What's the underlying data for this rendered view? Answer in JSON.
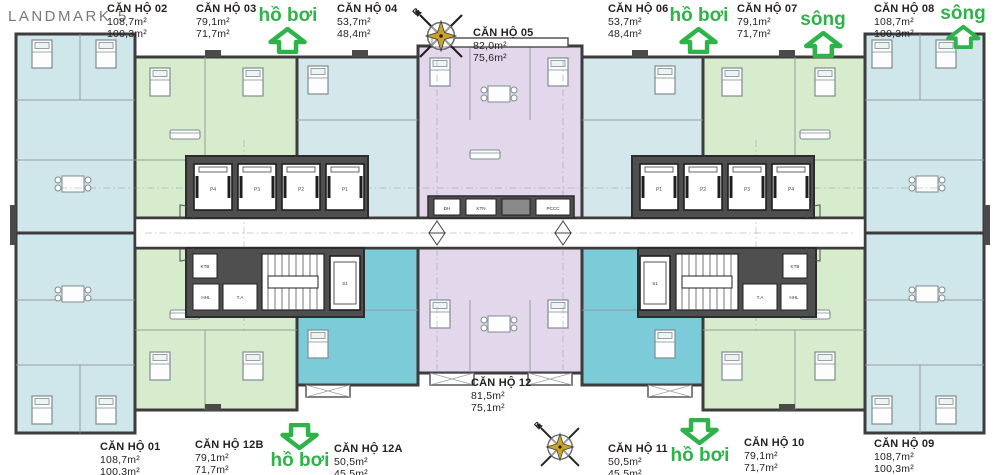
{
  "title": "LANDMARK 5",
  "units": {
    "u01": {
      "name": "CĂN HỘ 01",
      "area1": "108,7m²",
      "area2": "100,3m²"
    },
    "u02": {
      "name": "CĂN HỘ 02",
      "area1": "108,7m²",
      "area2": "100,3m²"
    },
    "u03": {
      "name": "CĂN HỘ 03",
      "area1": "79,1m²",
      "area2": "71,7m²"
    },
    "u04": {
      "name": "CĂN HỘ 04",
      "area1": "53,7m²",
      "area2": "48,4m²"
    },
    "u05": {
      "name": "CĂN HỘ 05",
      "area1": "82,0m²",
      "area2": "75,6m²"
    },
    "u06": {
      "name": "CĂN HỘ 06",
      "area1": "53,7m²",
      "area2": "48,4m²"
    },
    "u07": {
      "name": "CĂN HỘ 07",
      "area1": "79,1m²",
      "area2": "71,7m²"
    },
    "u08": {
      "name": "CĂN HỘ 08",
      "area1": "108,7m²",
      "area2": "100,3m²"
    },
    "u09": {
      "name": "CĂN HỘ 09",
      "area1": "108,7m²",
      "area2": "100,3m²"
    },
    "u10": {
      "name": "CĂN HỘ 10",
      "area1": "79,1m²",
      "area2": "71,7m²"
    },
    "u11": {
      "name": "CĂN HỘ 11",
      "area1": "50,5m²",
      "area2": "45,5m²"
    },
    "u12": {
      "name": "CĂN HỘ 12",
      "area1": "81,5m²",
      "area2": "75,1m²"
    },
    "u12A": {
      "name": "CĂN HỘ 12A",
      "area1": "50,5m²",
      "area2": "45,5m²"
    },
    "u12B": {
      "name": "CĂN HỘ 12B",
      "area1": "79,1m²",
      "area2": "71,7m²"
    }
  },
  "markers": {
    "pool": "hồ bơi",
    "river": "sông"
  },
  "compass": {
    "north": "B"
  },
  "core": {
    "left_elevators": [
      "P4",
      "P3",
      "P2",
      "P1"
    ],
    "right_elevators": [
      "P1",
      "P2",
      "P3",
      "P4"
    ],
    "service_elevator": "S1",
    "rooms": {
      "kt": "KTB",
      "hk": "HHL",
      "ta": "T.A"
    },
    "lobby": {
      "dh": "ĐH",
      "ktn": "KTN",
      "pccc": "PCCC"
    }
  },
  "colors": {
    "accent_green": "#2eb34a",
    "pale_blue": "#cfe6ea",
    "pale_green": "#d7ebcd",
    "teal": "#7bcbd8",
    "lavender": "#e3d7eb",
    "wall": "#3d3b3c",
    "core_gray": "#4f4f4f",
    "title_gray": "#77787b",
    "text_dark": "#262220",
    "compass_gold": "#c9a227"
  }
}
